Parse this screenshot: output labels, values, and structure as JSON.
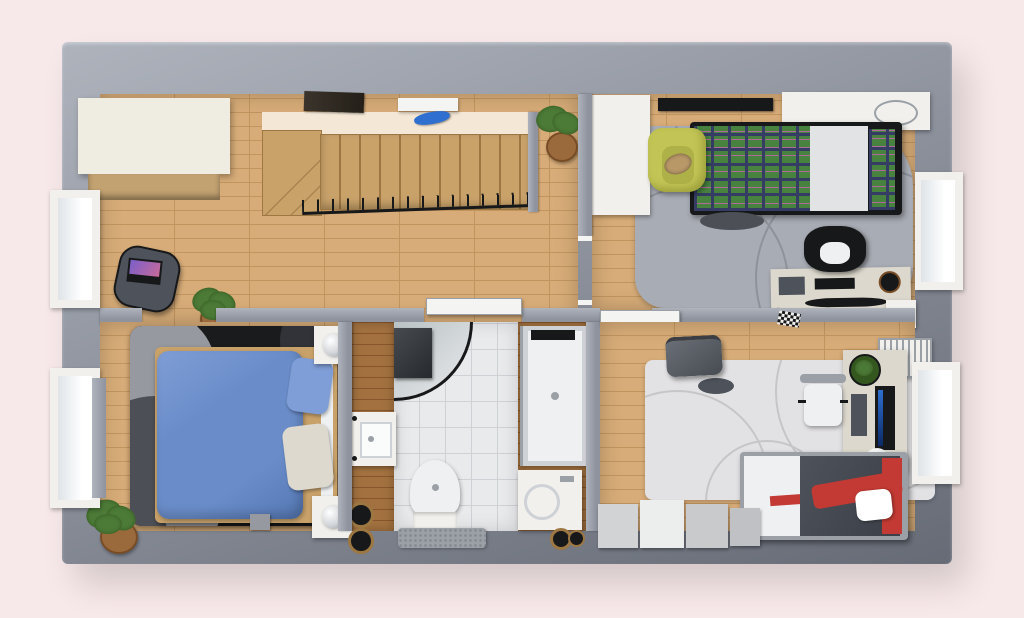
{
  "scene": {
    "description": "Top-down 3D rendered floor plan of an upper storey with landing, staircase, three bedrooms and a bathroom on a pink backdrop",
    "view": "top-down axonometric render",
    "visible_text": ""
  },
  "colors": {
    "bg": "#f7e8e9",
    "wall": "#8e939e",
    "wallLight": "#aeb3bc",
    "wallDark": "#666b76",
    "wood": "#d7ac78",
    "woodLine": "#c2955e",
    "walnut": "#a2713f",
    "walnutLine": "#86552c",
    "stair": "#c9a26a",
    "stairEdge": "#9d7742",
    "stairGap": "#f4e7d5",
    "tile": "#e9eaec",
    "tileLine": "#ced1d6",
    "rugDark": "#1a1b1d",
    "rugSpotLight": "#96999f",
    "rugSpotMid": "#4c4f55",
    "rugSpotDark": "#313338",
    "rugGray": "#a8acb4",
    "swirlGray": "#8e929a",
    "rugLight": "#e2e2e4",
    "swirlLight": "#c6c6c9",
    "blue": "#6a8dc9",
    "blueDark": "#5578b4",
    "bluePillow": "#7f9dd6",
    "pillowCream": "#ded9cf",
    "white": "#f1f0ed",
    "doorWhite": "#f4f4f2",
    "cream": "#efece1",
    "creamFront": "#c3a271",
    "plaidGreen": "#47833f",
    "plaidDark": "#353d64",
    "plaidPink": "#b06a9a",
    "sheet": "#e2e3e5",
    "yellow": "#c2c455",
    "yellowDark": "#9fa23d",
    "cat": "#b99868",
    "desk": "#dcd8cd",
    "black": "#17181a",
    "steel": "#9aa0a6",
    "red": "#c23a33",
    "duvetGray": "#4d525b",
    "bedWhite": "#eef0f2",
    "plant": "#4c7a37",
    "plantDark": "#33571f",
    "pot": "#9a6a3c",
    "potDark": "#784d26",
    "glass": "#b9c2c4",
    "glaze": "#dfe4e8",
    "lamp": "#d2d5d9",
    "blueDecor": "#2e6fd0",
    "laptopScreen": "#7a5fc9"
  },
  "rooms": [
    {
      "id": "hallway",
      "label": "Landing / hallway with staircase"
    },
    {
      "id": "bedroom-top-right",
      "label": "Bedroom with plaid bed and desk"
    },
    {
      "id": "bedroom-left",
      "label": "Master bedroom with blue bed"
    },
    {
      "id": "bathroom",
      "label": "Bathroom"
    },
    {
      "id": "bedroom-bottom-right",
      "label": "Bedroom with red bed and desk"
    }
  ],
  "items": {
    "hallway": [
      "cream wardrobe",
      "wooden staircase with railing",
      "wall shelf with blue decor",
      "dark wall vent",
      "side table with laptop",
      "potted plants"
    ],
    "bedroom_top_right": [
      "white wardrobe",
      "TV wall strip",
      "headboard console",
      "plaid double bed",
      "yellow armchair with cat",
      "gray swirl rug",
      "desk with curved monitor",
      "black office chair",
      "drawer unit",
      "window"
    ],
    "bedroom_left": [
      "blue double bed",
      "dark round-pattern rug",
      "two nightstands with lamps",
      "potted plants",
      "two windows"
    ],
    "bathroom": [
      "corner shower",
      "walk-in shower tray",
      "washing machine",
      "sink vanity",
      "toilet",
      "bath mat",
      "floor fixtures"
    ],
    "bedroom_bottom_right": [
      "light swirl rug",
      "gray suitcase",
      "desk with portrait monitor",
      "white chair",
      "radiator",
      "bed with red and gray bedding",
      "white storage cabinets",
      "window"
    ]
  }
}
